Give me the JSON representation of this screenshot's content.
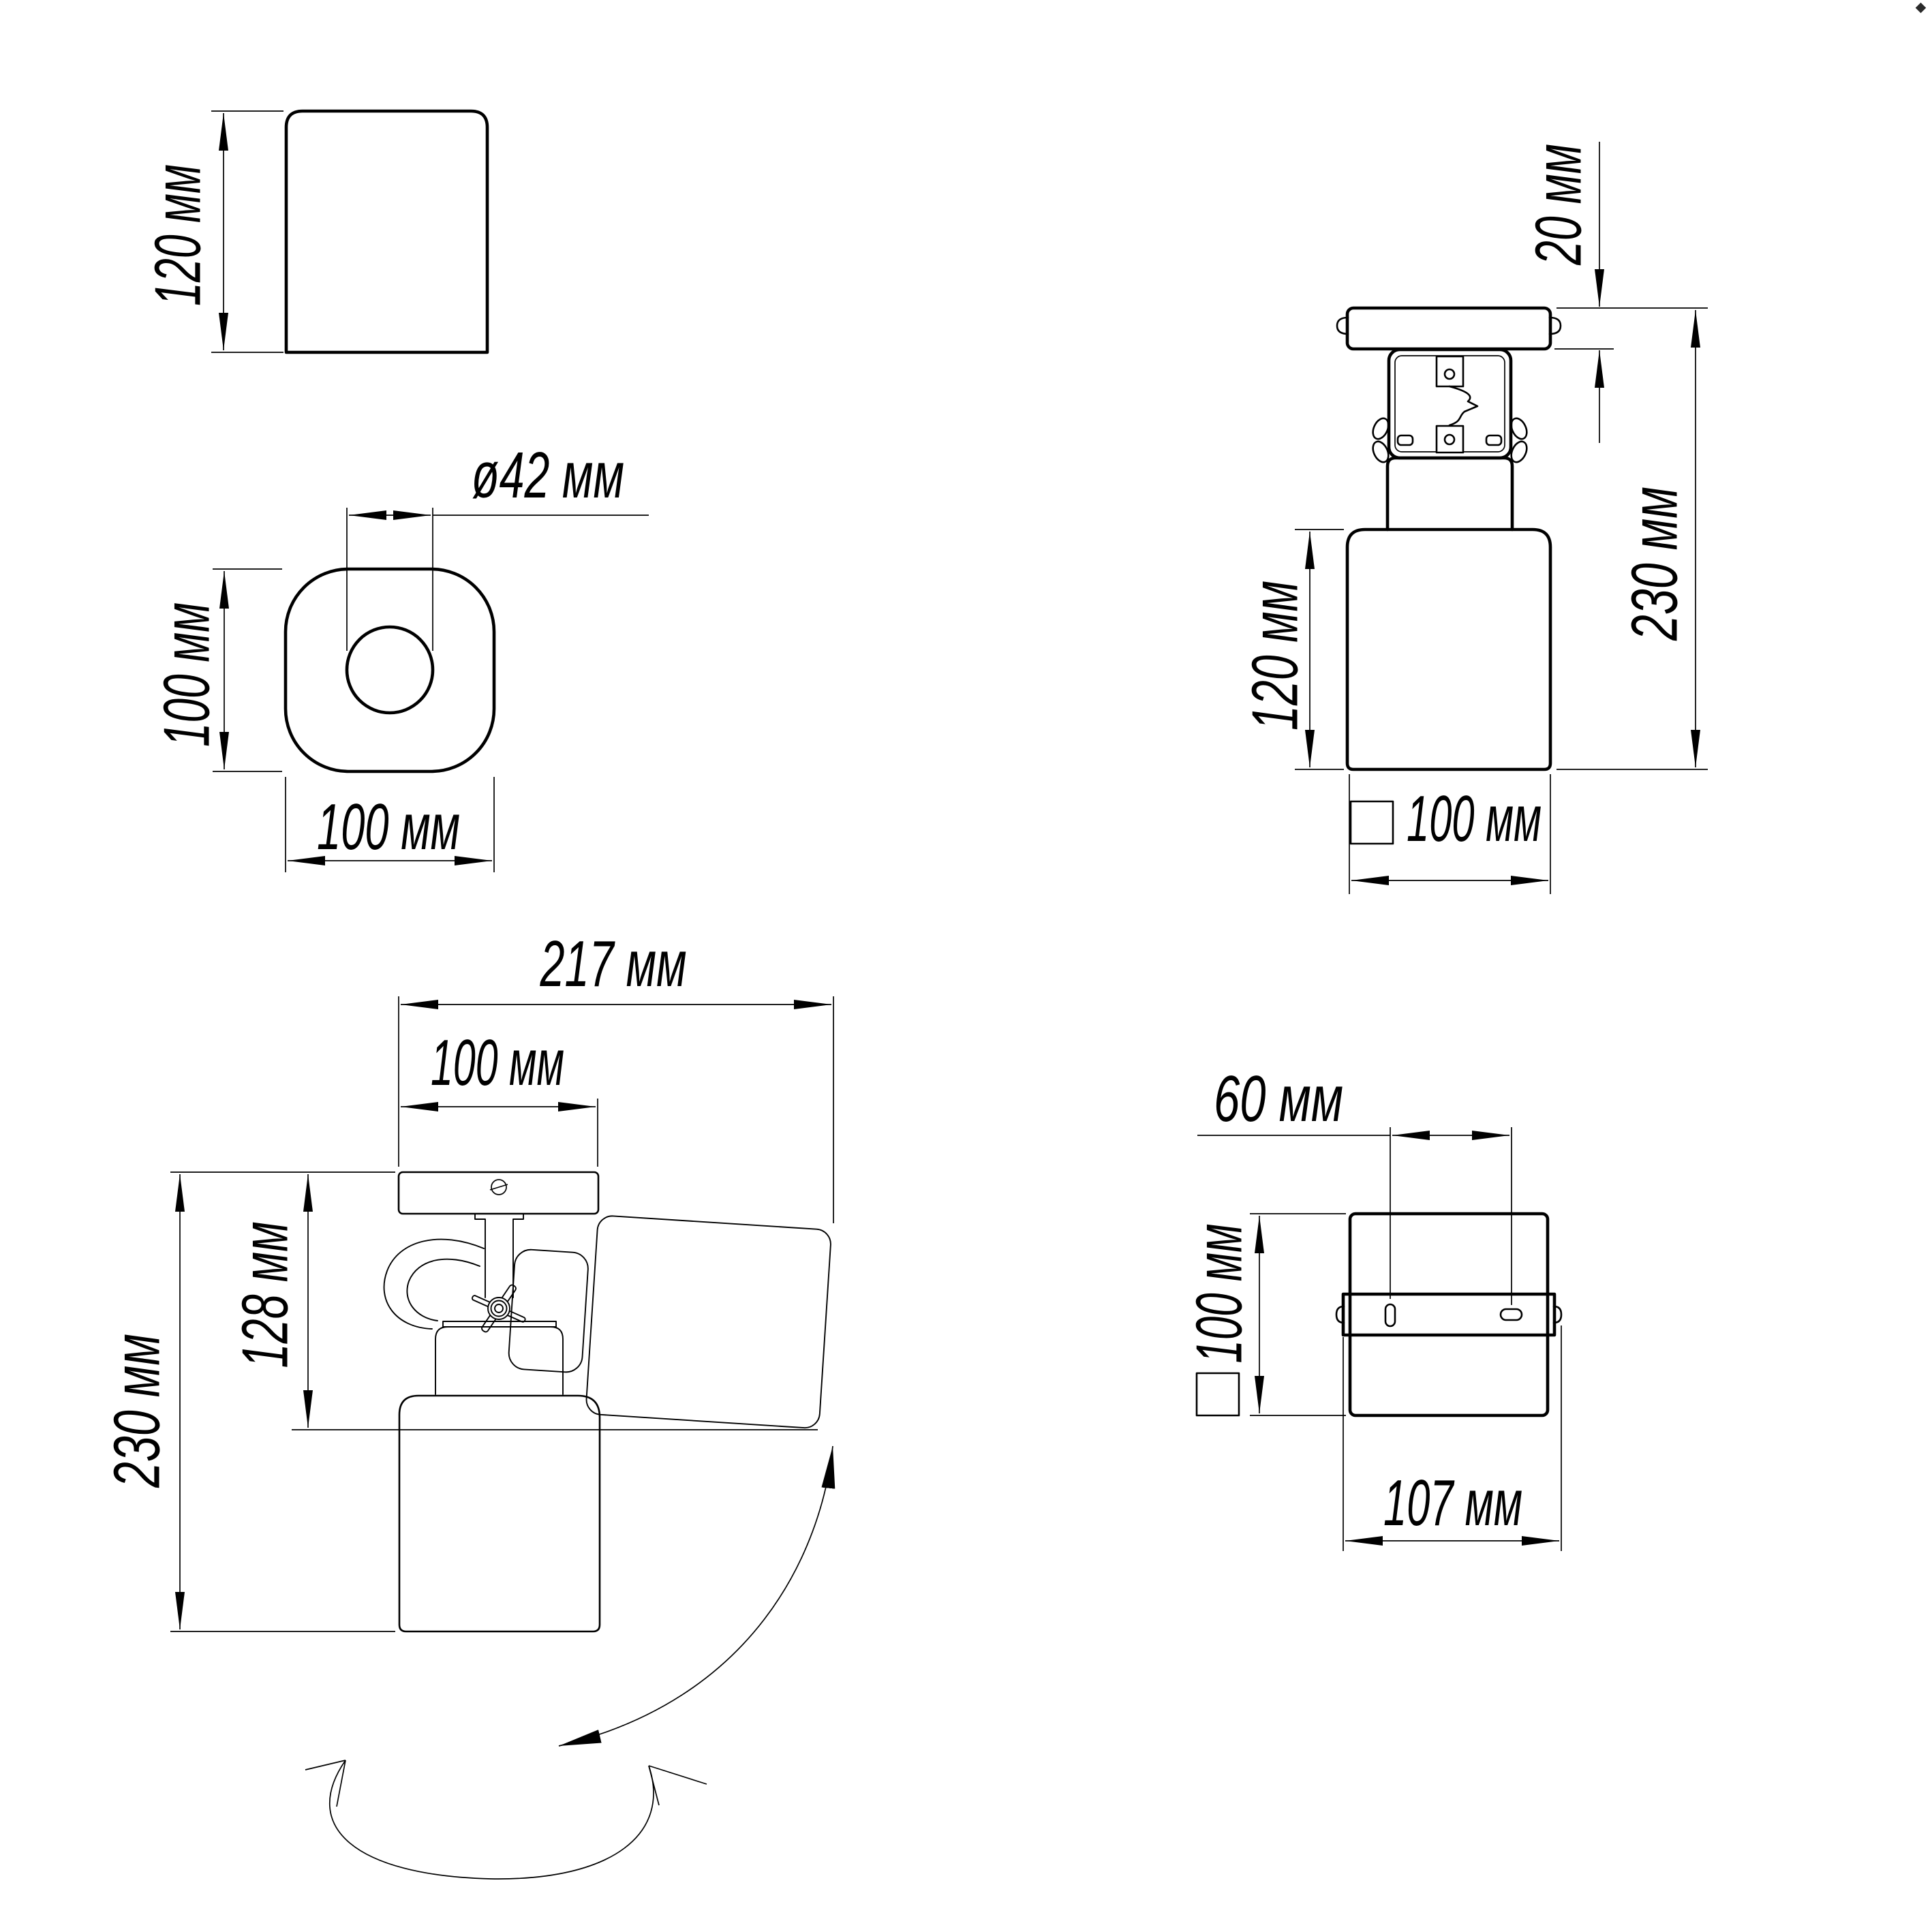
{
  "drawing": {
    "title": "spot-luminaire-dimension-drawing",
    "unit": "мм",
    "colors": {
      "line": "#000000",
      "background": "#ffffff"
    },
    "views": {
      "side": {
        "height": "120 мм"
      },
      "plan": {
        "hole_diameter": "ø42 мм",
        "depth": "100 мм",
        "width": "100 мм"
      },
      "front": {
        "canopy_thickness": "20 мм",
        "overall_height": "230 мм",
        "body_height": "120 мм",
        "width": "100 мм"
      },
      "tilted": {
        "max_width": "217 мм",
        "canopy_width": "100 мм",
        "overall_height": "230 мм",
        "pivot_height": "128 мм"
      },
      "bottom": {
        "slot_spacing": "60 мм",
        "body_width": "100 мм",
        "bracket_width": "107 мм"
      }
    }
  }
}
